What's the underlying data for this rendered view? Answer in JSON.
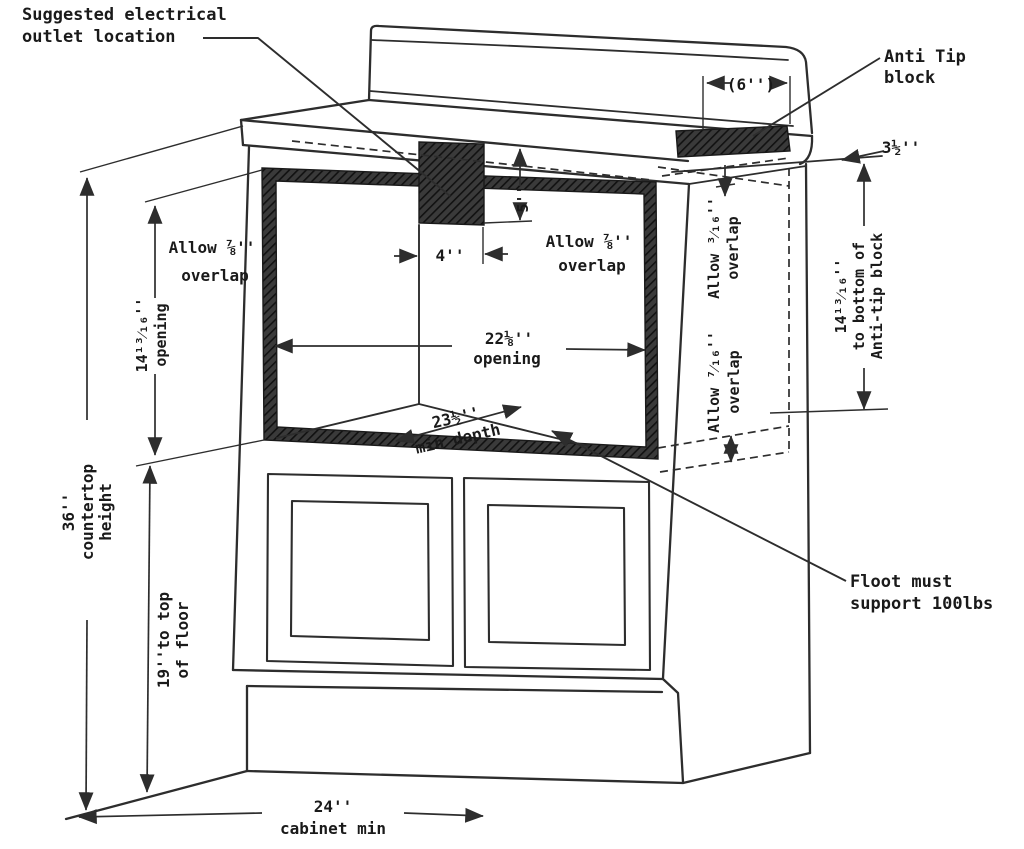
{
  "diagram": {
    "title": "Built-in appliance cabinet cutout installation drawing",
    "colors": {
      "line": "#2d2d2d",
      "text": "#1a1a1a",
      "hatch_base": "#3a3a3a",
      "hatch_line": "#111111",
      "background": "#ffffff"
    },
    "labels": {
      "outlet_line1": "Suggested electrical",
      "outlet_line2": "outlet location",
      "antitip_line1": "Anti Tip",
      "antitip_line2": "block",
      "dim_6in": "(6'')",
      "dim_3half": "3½''",
      "allow78_left_1": "Allow ⅞''",
      "allow78_left_2": "overlap",
      "allow78_right_1": "Allow ⅞''",
      "allow78_right_2": "overlap",
      "dim_5in": "5''",
      "dim_4in": "4''",
      "dim_opening_w_1": "22⅛''",
      "dim_opening_w_2": "opening",
      "allow316_1": "Allow ³⁄₁₆''",
      "allow316_2": "overlap",
      "allow716_1": "Allow ⁷⁄₁₆''",
      "allow716_2": "overlap",
      "dim_antitip_1": "14¹³⁄₁₆''",
      "dim_antitip_2": "to bottom of",
      "dim_antitip_3": "Anti-tip block",
      "dim_opening_h_1": "14¹³⁄₁₆''",
      "dim_opening_h_2": "opening",
      "dim_depth_1": "23½''",
      "dim_depth_2": "min depth",
      "dim_countertop_1": "36''",
      "dim_countertop_2": "countertop",
      "dim_countertop_3": "height",
      "dim_floor_1": "19''to top",
      "dim_floor_2": "of floor",
      "floor_support_1": "Floot must",
      "floor_support_2": "support 100lbs",
      "dim_cabinet_1": "24''",
      "dim_cabinet_2": "cabinet min"
    }
  }
}
